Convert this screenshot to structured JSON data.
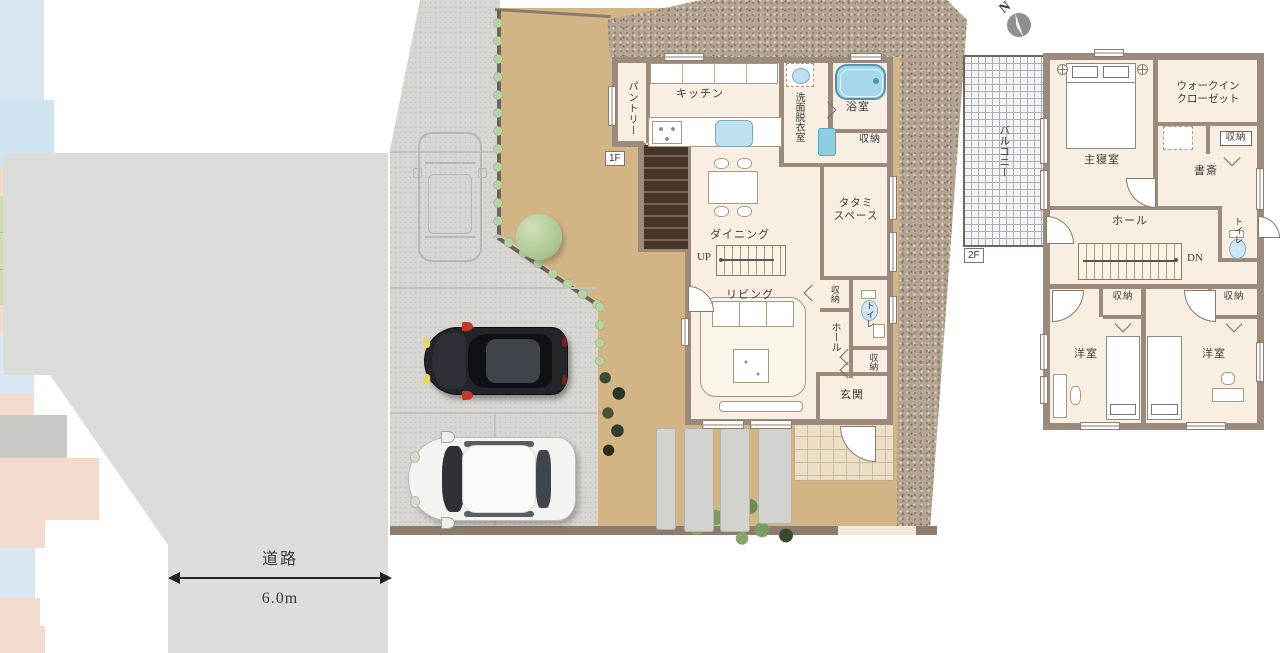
{
  "site": {
    "compass_label": "N",
    "road_label": "道路",
    "road_width_label": "6.0m"
  },
  "floor1": {
    "tag": "1F",
    "labels": {
      "pantry": "パントリー",
      "kitchen": "キッチン",
      "washroom": "洗面脱衣室",
      "bathroom": "浴室",
      "storage_top": "収納",
      "tatami_line1": "タタミ",
      "tatami_line2": "スペース",
      "dining": "ダイニング",
      "up": "UP",
      "living": "リビング",
      "storage_mid": "収納",
      "toilet": "トイレ",
      "hall": "ホール",
      "storage_entrance": "収納",
      "entrance": "玄関"
    }
  },
  "floor2": {
    "tag": "2F",
    "labels": {
      "balcony": "バルコニー",
      "master_bedroom": "主寝室",
      "wic_line1": "ウォークイン",
      "wic_line2": "クローゼット",
      "storage_top": "収納",
      "study": "書斎",
      "toilet": "トイレ",
      "hall": "ホール",
      "dn": "DN",
      "storage_left": "収納",
      "storage_right": "収納",
      "bedroom_left": "洋室",
      "bedroom_right": "洋室"
    }
  },
  "colors": {
    "wall": "#9c8b7c",
    "floor": "#f8efe2",
    "wet_area": "#d9e7f2",
    "tatami": "#cfe0ae",
    "storage": "#f3dccd",
    "entrance_floor": "#c9c8c4",
    "road": "#dcdcda",
    "driveway": "#d7d6d2",
    "garden": "#d2b485",
    "gravel": "#b3a393",
    "tub": "#a5d8ea"
  }
}
